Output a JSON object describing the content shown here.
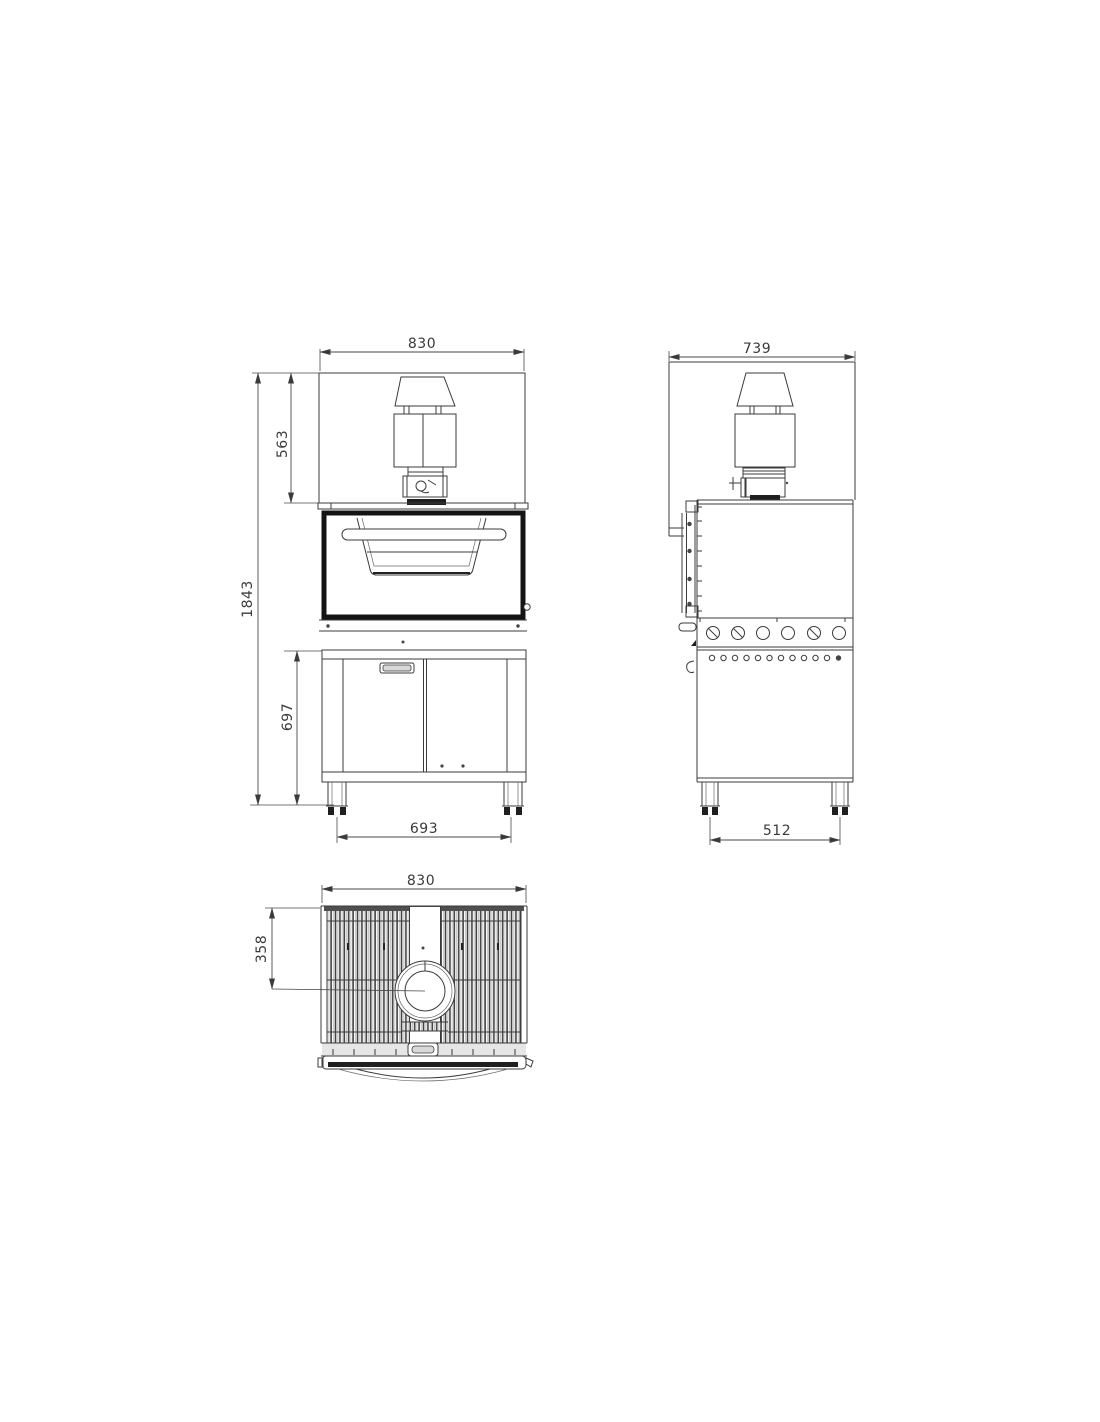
{
  "drawing": {
    "line_color": "#3b3b3b",
    "dim_color": "#4a4a4a",
    "fill_light": "#d9d9d9",
    "fill_dark": "#1f1f1f"
  },
  "views": {
    "front": {
      "dims": {
        "width": "830",
        "flue_height": "563",
        "total_height": "1843",
        "base_height": "697",
        "feet_span": "693"
      }
    },
    "side": {
      "dims": {
        "depth": "739",
        "feet_span": "512"
      }
    },
    "top": {
      "dims": {
        "width": "830",
        "flue_offset": "358"
      }
    }
  }
}
